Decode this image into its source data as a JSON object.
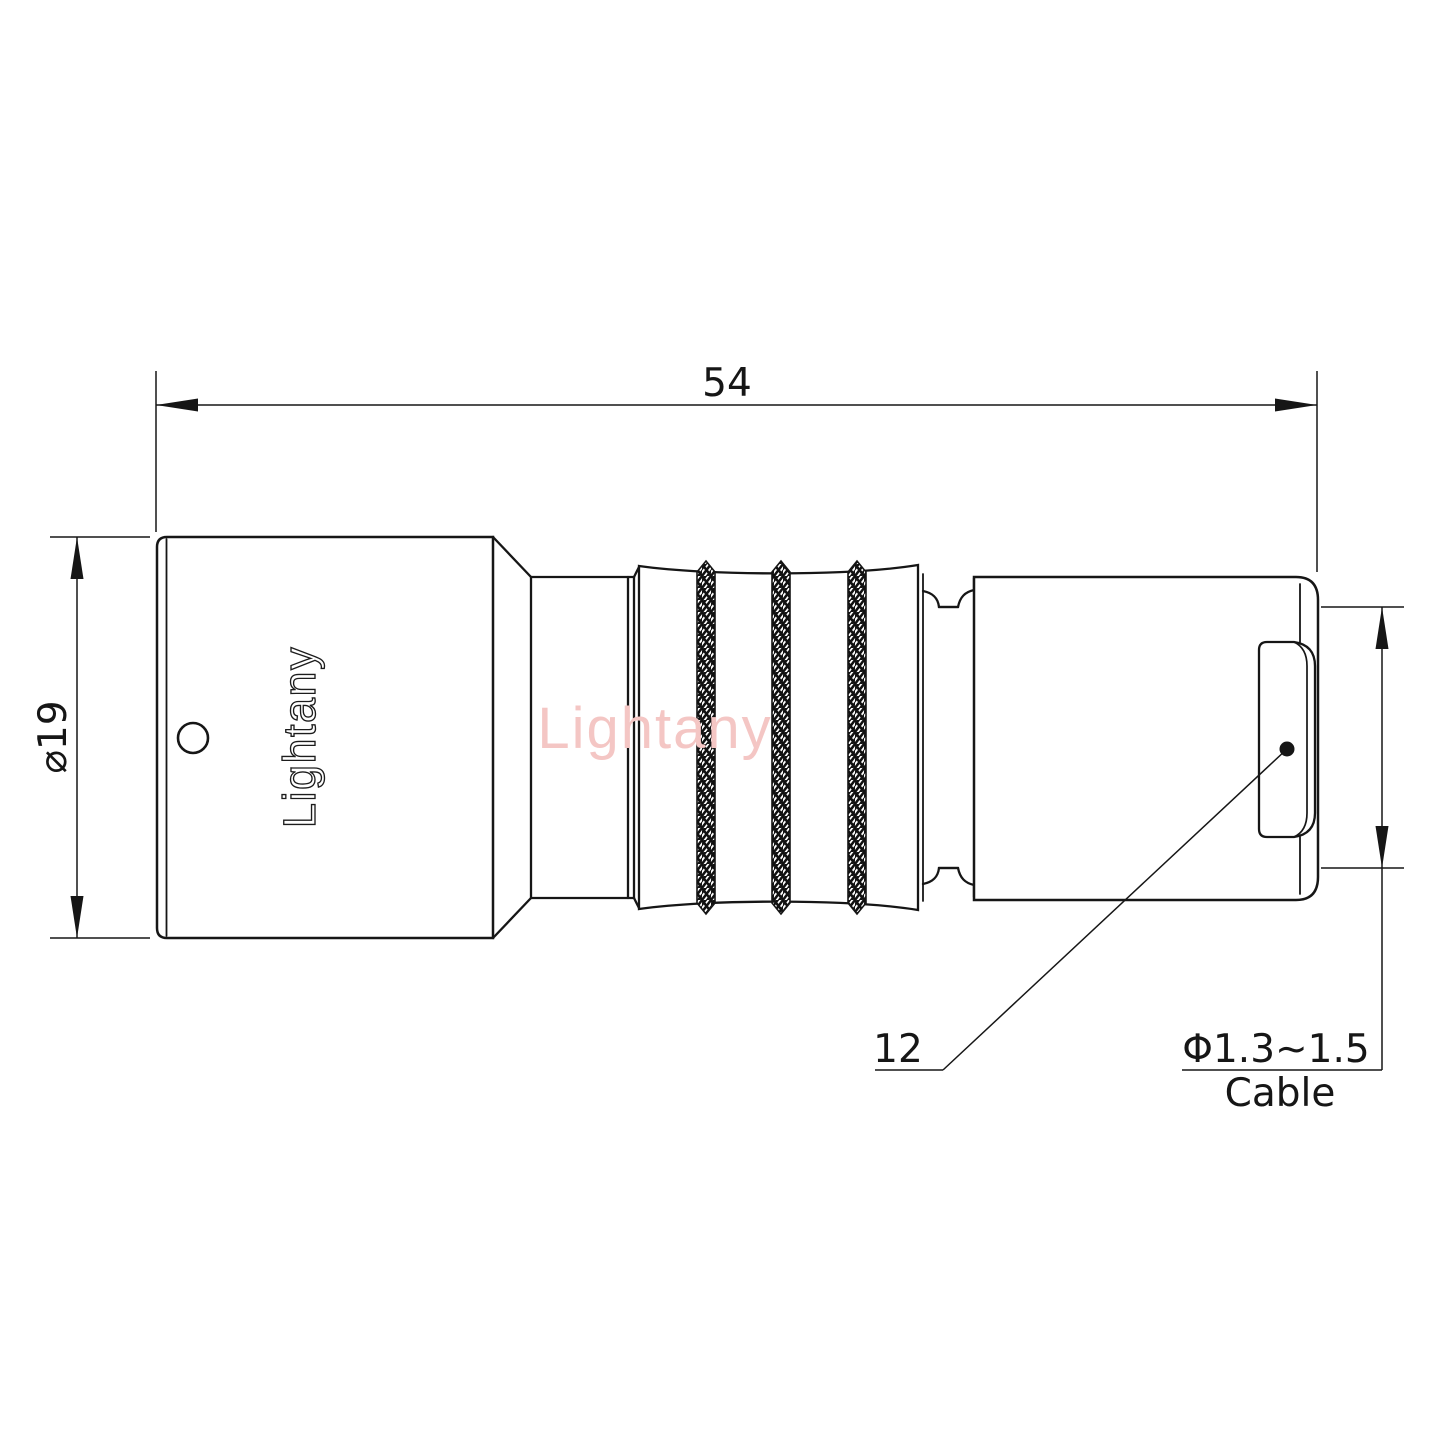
{
  "title": "connector-technical-drawing",
  "watermark": {
    "text": "Lightany",
    "color": "#f4c6c4"
  },
  "engraving": {
    "text": "Lightany"
  },
  "dimensions": {
    "overall_length": {
      "value": "54"
    },
    "front_body_diameter": {
      "value": "⌀19"
    },
    "leader_dim": {
      "value": "12"
    },
    "cable_dim": {
      "range": "Φ1.3~1.5",
      "label": "Cable"
    }
  },
  "colors": {
    "line": "#161616",
    "background": "#ffffff",
    "knurl": "#111111"
  }
}
